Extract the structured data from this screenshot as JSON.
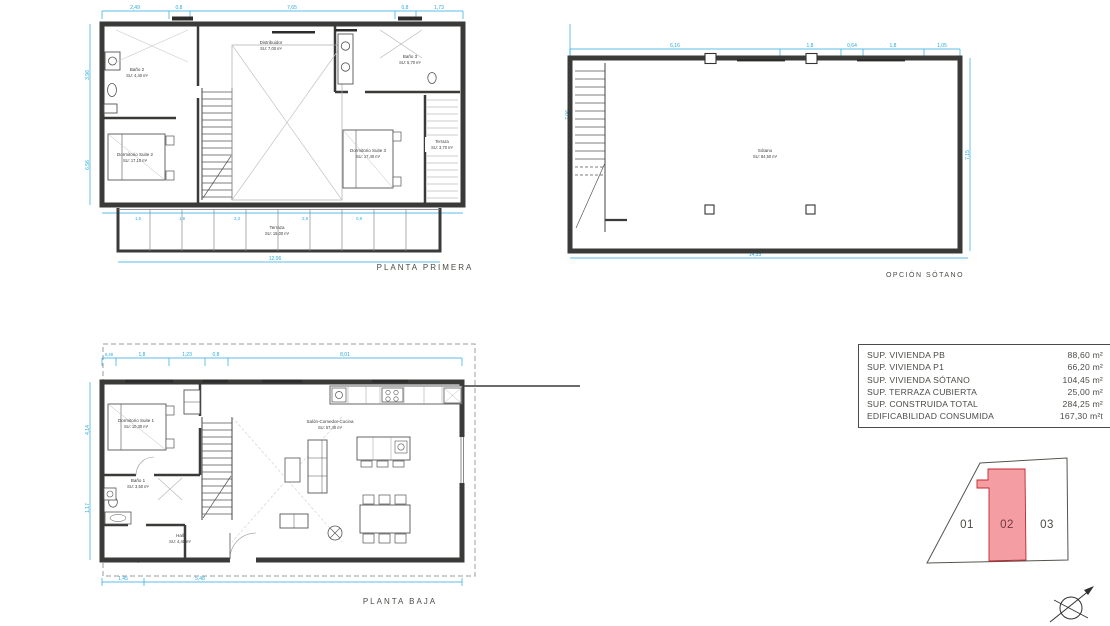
{
  "plans": {
    "planta_primera": {
      "title": "PLANTA PRIMERA",
      "rooms": {
        "bano2": {
          "name": "Baño 2",
          "area": "SU: 4,40 m²"
        },
        "distribuidor": {
          "name": "Distribuidor",
          "area": "SU: 7,00 m²"
        },
        "bano3": {
          "name": "Baño 3",
          "area": "SU: 5,70 m²"
        },
        "suite2": {
          "name": "Dormitorio Suite 2",
          "area": "SU: 17,10 m²"
        },
        "suite3": {
          "name": "Dormitorio Suite 3",
          "area": "SU: 17,40 m²"
        },
        "terraza_lateral": {
          "name": "Terraza",
          "area": "SU: 3,70 m²"
        },
        "terraza": {
          "name": "Terraza",
          "area": "SU: 15,00 m²"
        }
      },
      "dims": {
        "top": [
          "2,49",
          "0,8",
          "7,65",
          "0,8",
          "1,73"
        ],
        "left": [
          "3,96",
          "6,56"
        ],
        "right": [
          "7,06"
        ],
        "inner": [
          "4,84",
          "1,1",
          "2,1",
          "2,75",
          "1,48",
          "3,38",
          "4,85",
          "3,17"
        ],
        "bottom": [
          "1,5",
          "1,8",
          "2,3",
          "2,8",
          "0,8"
        ],
        "total": "12,06"
      }
    },
    "opcion_sotano": {
      "title": "OPCIÓN SÓTANO",
      "room": {
        "name": "Sótano",
        "area": "SU: 84,50 m²"
      },
      "dims": {
        "top": [
          "6,16",
          "1,8",
          "0,64",
          "1,8",
          "1,05"
        ],
        "right": [
          "7,15"
        ],
        "inner_width": "13,48",
        "total": "14,33"
      }
    },
    "planta_baja": {
      "title": "PLANTA BAJA",
      "rooms": {
        "suite1": {
          "name": "Dormitorio Suite 1",
          "area": "SU: 10,30 m²"
        },
        "bano1": {
          "name": "Baño 1",
          "area": "SU: 3,50 m²"
        },
        "hall": {
          "name": "Hall",
          "area": "SU: 4,40 m²"
        },
        "salon": {
          "name": "Salón-Comedor-Cocina",
          "area": "SU: 57,40 m²"
        }
      },
      "dims": {
        "top": [
          "0,48",
          "1,8",
          "1,23",
          "0,8",
          "8,01"
        ],
        "left": [
          "4,14",
          "1,17"
        ],
        "right": [
          "1,88",
          "3,8"
        ],
        "inner": [
          "0,7",
          "6,5",
          "1,05",
          "1,7",
          "1,65"
        ],
        "bottom": [
          "1,45",
          "5,48"
        ]
      }
    }
  },
  "summary_table": {
    "rows": [
      {
        "label": "SUP. VIVIENDA PB",
        "value": "88,60 m²"
      },
      {
        "label": "SUP. VIVIENDA P1",
        "value": "66,20 m²"
      },
      {
        "label": "SUP. VIVIENDA SÓTANO",
        "value": "104,45 m²"
      },
      {
        "label": "SUP. TERRAZA CUBIERTA",
        "value": "25,00 m²"
      },
      {
        "label": "SUP. CONSTRUIDA TOTAL",
        "value": "284,25 m²"
      },
      {
        "label": "EDIFICABILIDAD CONSUMIDA",
        "value": "167,30 m²t"
      }
    ]
  },
  "parcels": {
    "labels": [
      "01",
      "02",
      "03"
    ],
    "highlighted": "02"
  },
  "colors": {
    "dimension": "#29a8df",
    "wall": "#3a3a38",
    "highlight_fill": "#f49da3",
    "highlight_border": "#c1272d",
    "label": "#4b4b47"
  }
}
